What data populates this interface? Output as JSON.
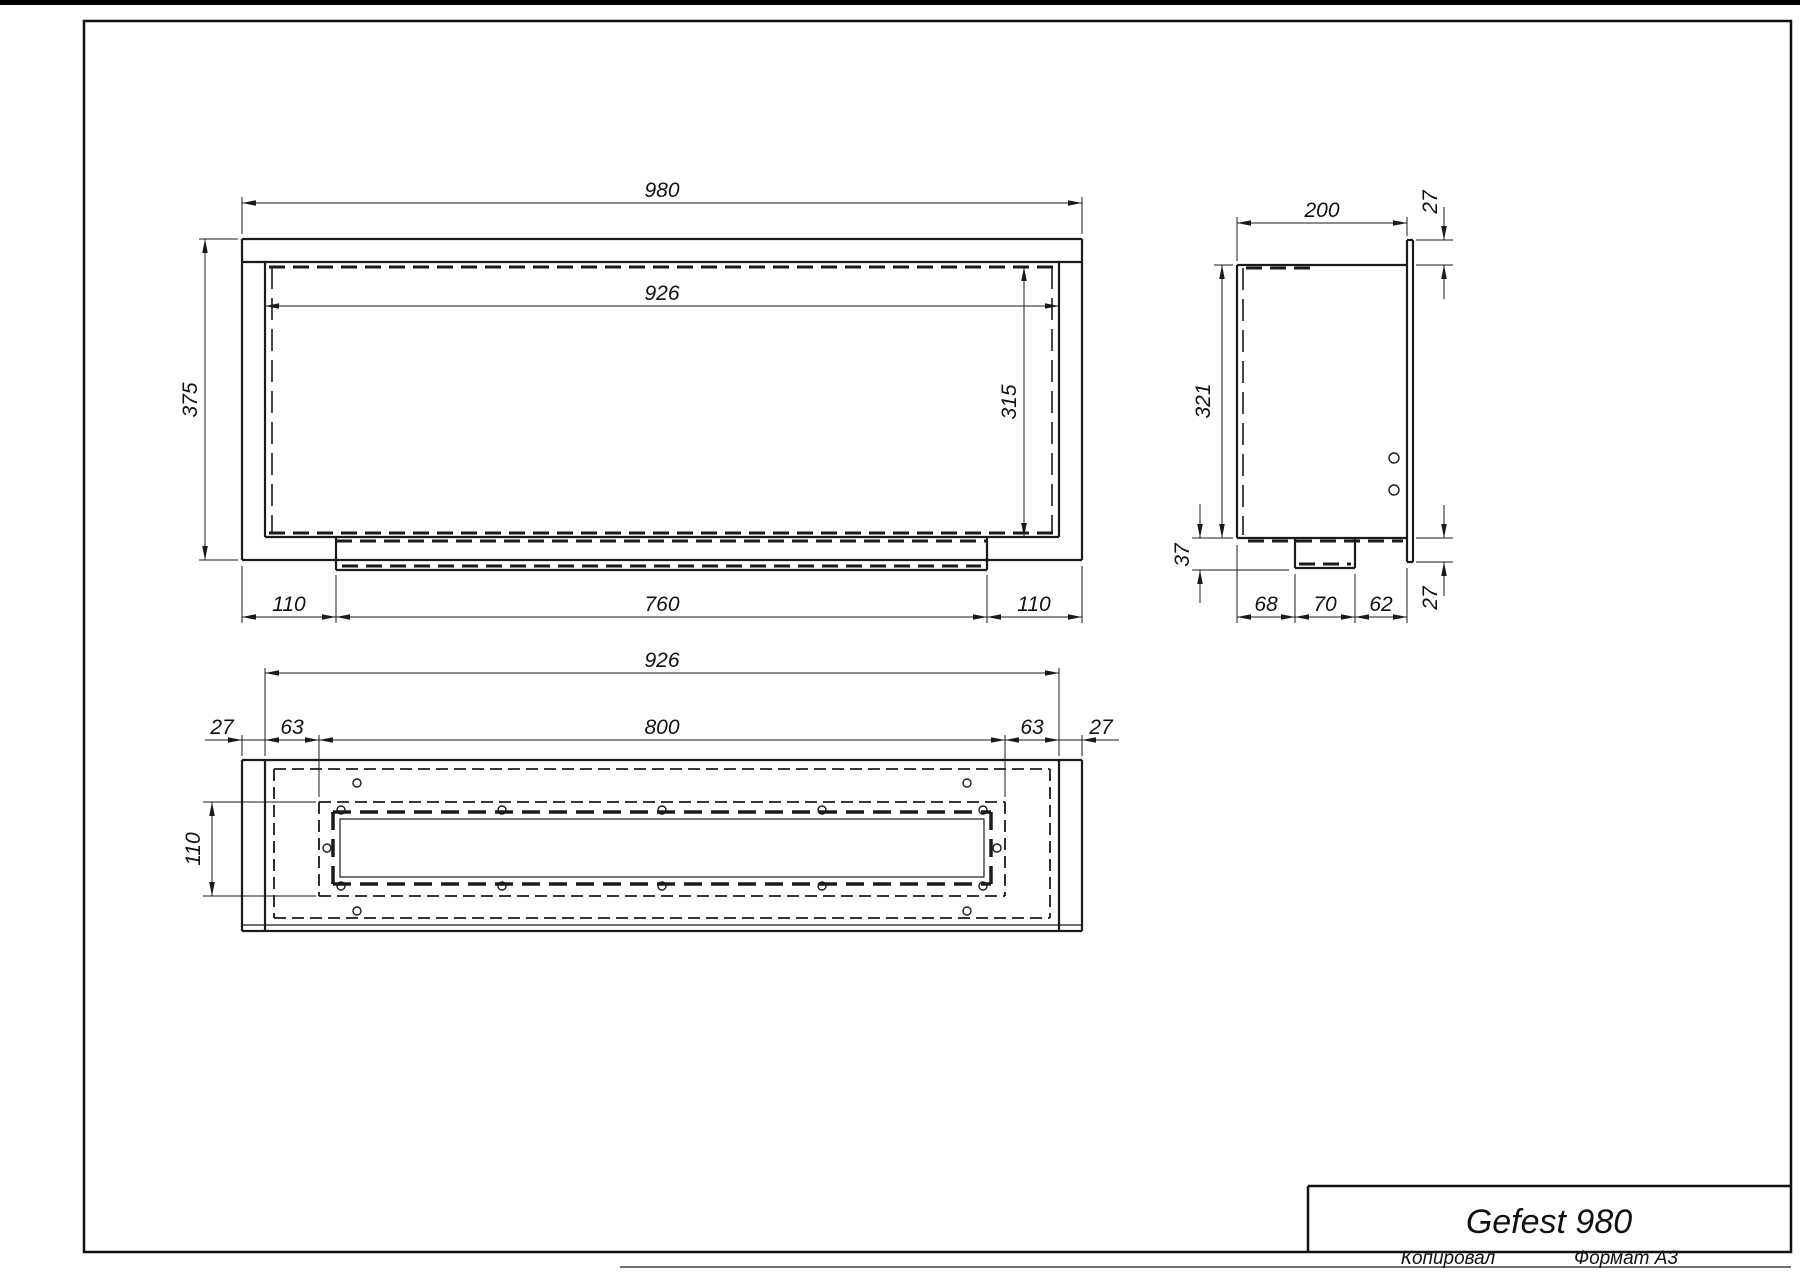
{
  "drawing": {
    "title": "Gefest 980",
    "footer": {
      "copied": "Копировал",
      "format": "Формат А3"
    },
    "front_view": {
      "width": "980",
      "inner_width": "926",
      "height": "375",
      "inner_height": "315",
      "bottom_left": "110",
      "bottom_center": "760",
      "bottom_right": "110"
    },
    "side_view": {
      "depth": "200",
      "top_flange": "27",
      "height": "321",
      "tray_drop": "37",
      "bottom_segments": [
        "68",
        "70",
        "62"
      ],
      "bottom_flange": "27"
    },
    "bottom_view": {
      "width": "926",
      "slot_width": "800",
      "flange_left": "27",
      "inset_left": "63",
      "inset_right": "63",
      "flange_right": "27",
      "slot_depth": "110"
    }
  }
}
